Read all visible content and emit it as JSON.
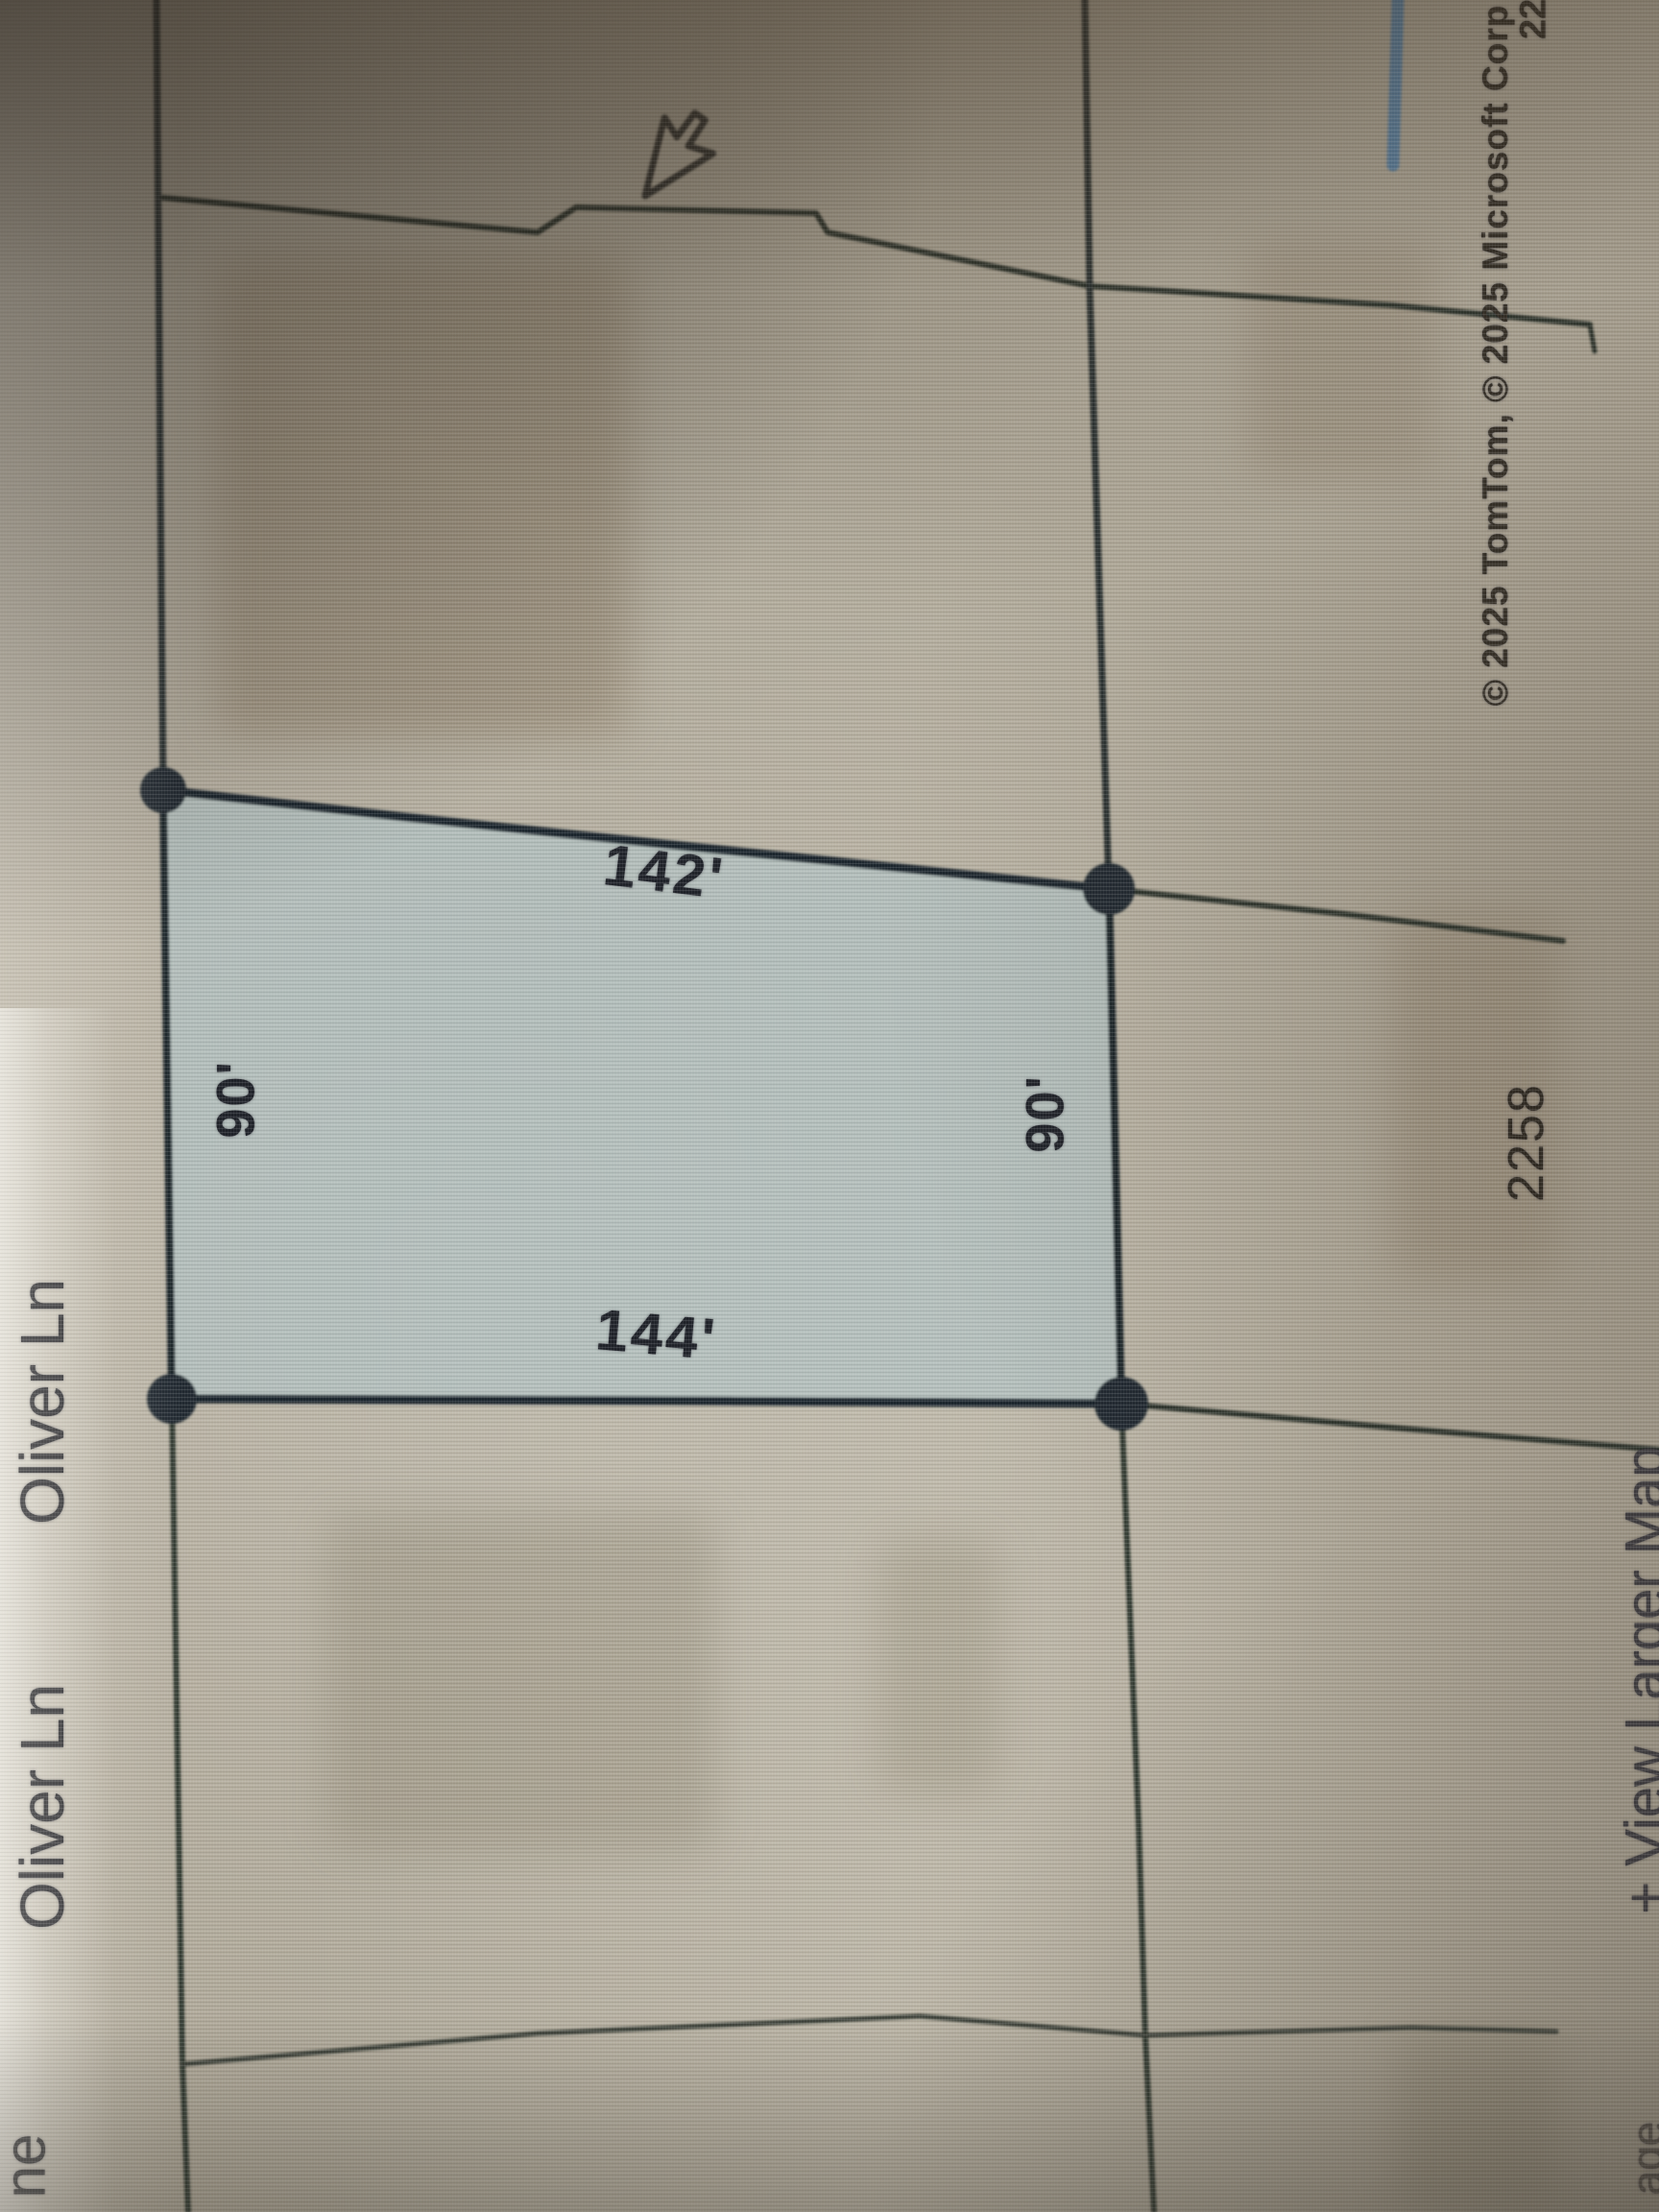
{
  "map": {
    "streets": {
      "oliver_ln_1": "Oliver Ln",
      "oliver_ln_2": "Oliver Ln"
    },
    "highlighted_parcel": {
      "width_top": "142'",
      "width_bottom": "144'",
      "depth_left": "90'",
      "depth_right": "90'",
      "fill_color": "#aec2c6",
      "outline_color": "#1f2a33"
    },
    "adjacent_parcel_number": "2258",
    "attribution": "© 2025 TomTom, © 2025 Microsoft Corp",
    "attribution_fragment_top_right": "22",
    "edge_fragment_bottom_left": "ne",
    "edge_fragment_bottom_right": "age",
    "view_larger_map_link": "+ View Larger Map",
    "accent_blue": "#4a7cab",
    "cursor": "arrow-pointer"
  }
}
